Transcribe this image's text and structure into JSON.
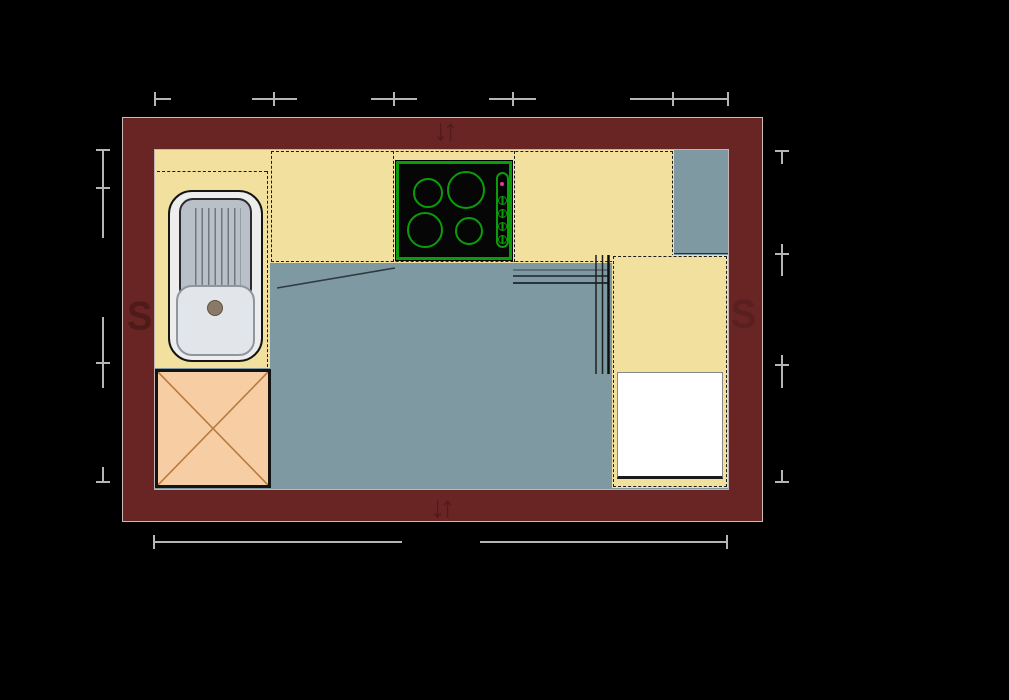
{
  "diagram": {
    "type": "kitchen floor plan (top view, CAD style)",
    "title": "",
    "wall_symbols": {
      "top": "↓↑",
      "bottom": "↓↑",
      "left": "S",
      "right": "S"
    },
    "fixtures": {
      "sink": "single-bowl sink with ribbed drainboard and drain",
      "cooktop": "four-burner cooktop with side control panel, 4 knobs and pink indicator light",
      "corner_cabinet": "base unit marked with X cross",
      "appliance": "white built-in appliance front",
      "counters": [
        "left counter",
        "top counter",
        "right counter"
      ]
    },
    "dimensions": {
      "note": "dimension lines with end and intermediate ticks; labels not visible (black on black)",
      "top_tick_positions_px": [
        155,
        274,
        394,
        513,
        673,
        728
      ],
      "bottom_tick_positions_px": [
        154,
        727
      ],
      "left_tick_positions_px": [
        150,
        188,
        363,
        482
      ],
      "right_tick_positions_px": [
        151,
        254,
        365,
        482
      ]
    },
    "colors": {
      "background": "#000000",
      "wall": "#692424",
      "wall_outline": "#cbbcbc",
      "wall_symbol": "#4f1a1a",
      "counter": "#f2e09e",
      "floor": "#7f99a2",
      "corner_cabinet": "#f7cda3",
      "cabinet_cross": "#b97a3e",
      "cooktop_green": "#0a9d0a",
      "indicator_pink": "#e73895",
      "appliance": "#ffffff",
      "sink_steel": "#b9c0c8",
      "dimension_line": "#b5b5b5",
      "dashed_line": "#1c1c1c"
    }
  }
}
